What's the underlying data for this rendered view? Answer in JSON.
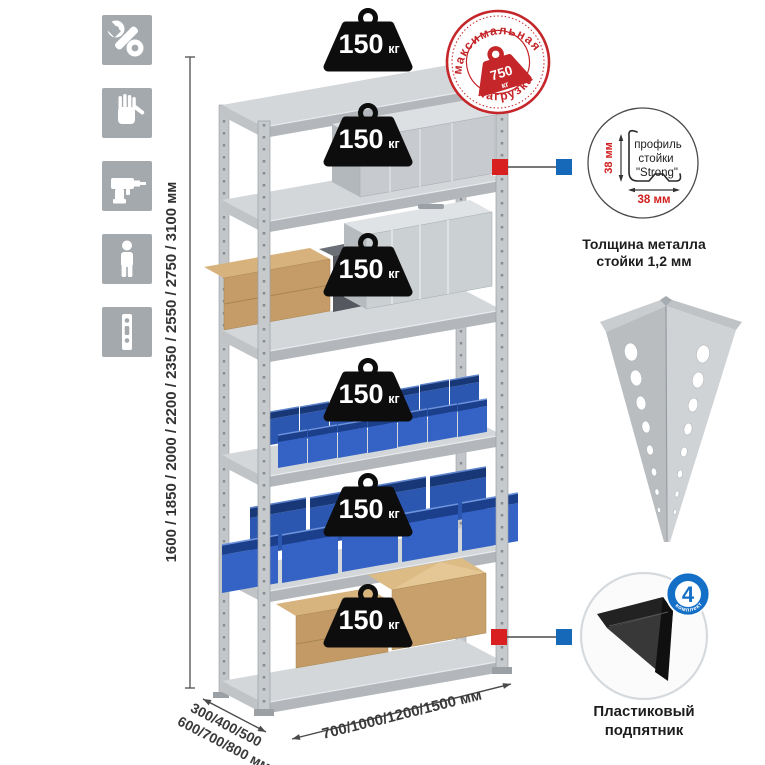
{
  "page": {
    "background": "#ffffff"
  },
  "sidebar": {
    "icons": [
      {
        "name": "wrench"
      },
      {
        "name": "gloves"
      },
      {
        "name": "drill"
      },
      {
        "name": "person"
      },
      {
        "name": "rack-post"
      }
    ]
  },
  "rack": {
    "shelf_loads": [
      {
        "value": "150",
        "unit": "кг"
      },
      {
        "value": "150",
        "unit": "кг"
      },
      {
        "value": "150",
        "unit": "кг"
      },
      {
        "value": "150",
        "unit": "кг"
      },
      {
        "value": "150",
        "unit": "кг"
      },
      {
        "value": "150",
        "unit": "кг"
      }
    ]
  },
  "max_load_stamp": {
    "arc_top": "максимальная",
    "arc_bottom": "нагрузка",
    "value": "750",
    "unit": "кг"
  },
  "dimensions": {
    "height_options": "1600 / 1850 / 2000 / 2200 / 2350 / 2550 / 2750 / 3100 мм",
    "depth_options_line1": "300/400/500",
    "depth_options_line2": "600/700/800 мм",
    "width_options": "700/1000/1200/1500 мм"
  },
  "profile_detail": {
    "label_line1": "профиль",
    "label_line2": "стойки",
    "label_line3": "\"Strong\"",
    "vertical_dim": "38 мм",
    "horizontal_dim": "38 мм",
    "caption_line1": "Толщина металла",
    "caption_line2": "стойки 1,2 мм"
  },
  "foot_detail": {
    "badge_number": "4",
    "badge_arc_text": "в комплекте",
    "caption_line1": "Пластиковый",
    "caption_line2": "подпятник"
  },
  "colors": {
    "accent_red": "#d02020",
    "accent_blue": "#1668b8",
    "stamp_red": "#c4262a",
    "icon_gray": "#a4a9ad",
    "bin_blue": "#3463c5",
    "cardboard": "#c59c68",
    "metal_light": "#d4d7da",
    "metal_dark": "#b3b7bb"
  }
}
